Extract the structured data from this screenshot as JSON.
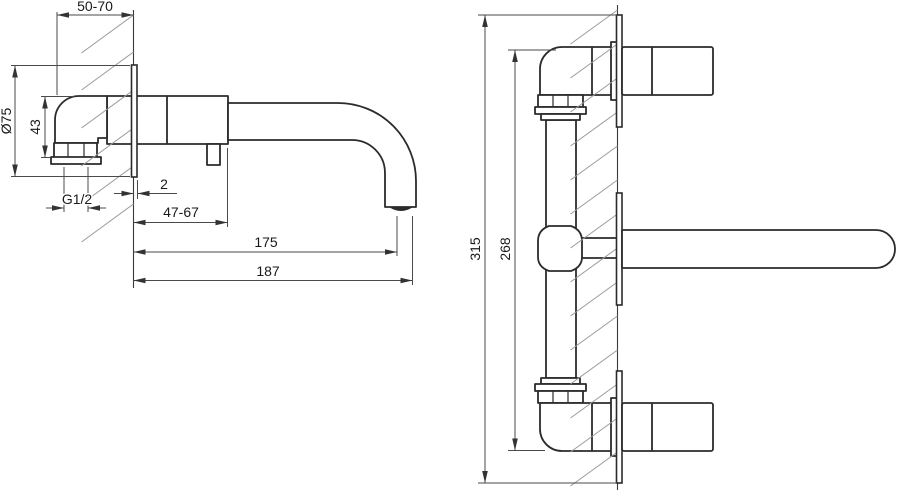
{
  "colors": {
    "background": "#ffffff",
    "line": "#2b2b2b",
    "dimension_line": "#4a4a4a",
    "hatch": "#9a9a9a",
    "text": "#1a1a1a"
  },
  "side_view": {
    "dims": {
      "in_wall_depth": "50-70",
      "plate_diameter": "Ø75",
      "body_height": "43",
      "thread": "G1/2",
      "plate_offset": "2",
      "body_projection": "47-67",
      "spout_reach": "175",
      "overall_reach": "187"
    }
  },
  "front_view": {
    "dims": {
      "overall_height": "315",
      "body_height": "268"
    }
  }
}
